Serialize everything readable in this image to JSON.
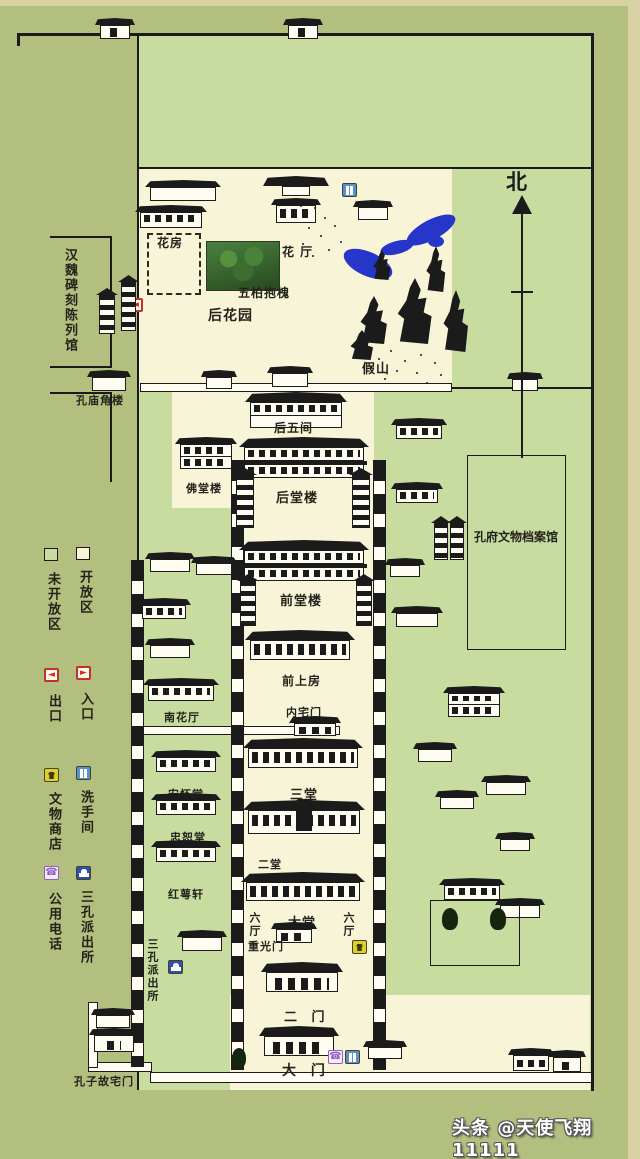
{
  "legend": {
    "closed": "未开放区",
    "open": "开放区",
    "exit": "出口",
    "entrance": "入口",
    "shop": "文物商店",
    "restroom": "洗手间",
    "phone": "公用电话",
    "police": "三孔派出所"
  },
  "compass": {
    "north": "北"
  },
  "west_outside": {
    "hanwei": "汉魏碑刻陈列馆",
    "corner_tower": "孔庙角楼"
  },
  "garden": {
    "flower_house": "花房",
    "flower_hall": "花 厅",
    "five_cypress": "五柏抱槐",
    "back_garden": "后花园",
    "rockery": "假山"
  },
  "axis": {
    "hou_wu_jian": "后五间",
    "fo_tang_lou": "佛堂楼",
    "hou_tang_lou": "后堂楼",
    "qian_tang_lou": "前堂楼",
    "qian_shang_fang": "前上房",
    "nei_zhai_men": "内宅门",
    "nan_hua_ting": "南花厅",
    "san_tang": "三堂",
    "an_huai_tang": "安怀堂",
    "zhong_shu_tang": "忠恕堂",
    "er_tang": "二堂",
    "hong_e_xuan": "红萼轩",
    "da_tang": "大堂",
    "liu_ting": "六厅",
    "chong_guang_men": "重光门",
    "er_men": "二 门",
    "police_station": "三孔派出所",
    "da_men": "大 门",
    "guzhai_men": "孔子故宅门"
  },
  "east": {
    "archives": "孔府文物档案馆"
  },
  "watermark": "头条 @天使飞翔11111",
  "colors": {
    "background": "#b2bf7e",
    "open_area": "#f8f4d8",
    "closed_area": "#c9dca0",
    "ink": "#1b1b1b",
    "pond": "#2636c8",
    "exit_red": "#c43226",
    "shop_yellow": "#e3cd2a",
    "phone_purple": "#8e5fc0",
    "police_blue": "#2d50b4",
    "toilet_blue": "#5a8fd0"
  }
}
